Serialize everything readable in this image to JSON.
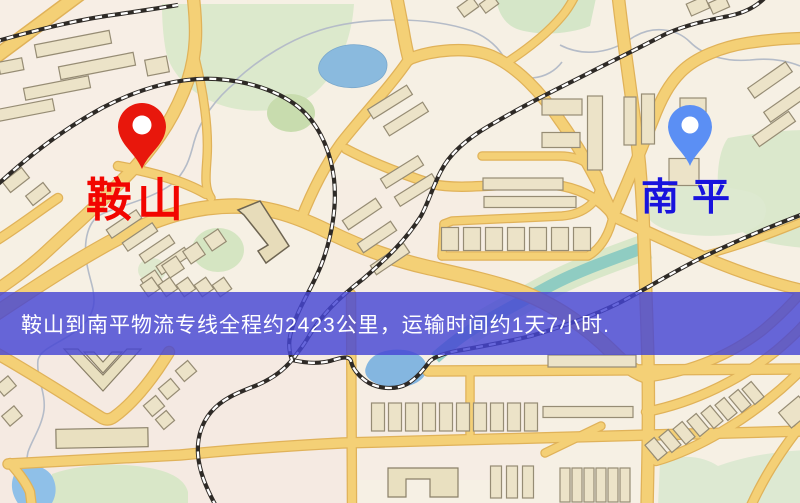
{
  "map": {
    "origin": {
      "label": "鞍山",
      "pin_color": "#e8170c",
      "label_color": "#f20500"
    },
    "destination": {
      "label": "南平",
      "pin_color": "#5b8ff4",
      "label_color": "#1813dd"
    },
    "banner": {
      "text": "鞍山到南平物流专线全程约2423公里，运输时间约1天7小时.",
      "background_color": "#4646d4",
      "text_color": "#ffffff"
    },
    "route": {
      "distance_km": "2423",
      "duration": "1天7小时"
    },
    "palette": {
      "background": "#f6f0e4",
      "road": "#f4d076",
      "road_casing": "#e0b259",
      "building": "#ece3c8",
      "park_green": "#dce9cc",
      "water_blue": "#8abade",
      "river_teal": "#8fccc2",
      "railway": "#2e2a26"
    }
  }
}
